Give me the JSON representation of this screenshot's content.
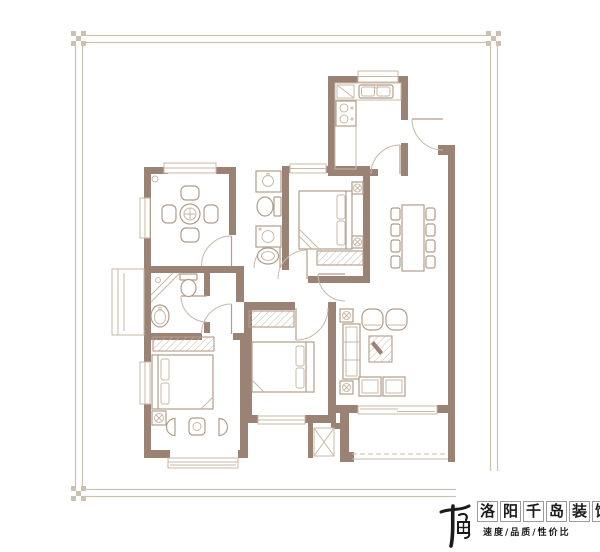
{
  "brand": {
    "logo_mark": "千岛",
    "name": "洛阳千岛装饰",
    "tagline": "速度/品质/性价比"
  },
  "colors": {
    "wall": "#9a8374",
    "furniture": "#b29c8a",
    "fine": "#c9b9a6",
    "frame": "#ccc0ae",
    "ink": "#1b1b1b",
    "background": "#ffffff"
  },
  "floorplan": {
    "type": "residential-floor-plan",
    "rooms": [
      "study",
      "kitchen",
      "bathroom-1",
      "bedroom-1",
      "dining-area",
      "living-room",
      "bathroom-2",
      "bedroom-2",
      "bedroom-3",
      "balcony",
      "entry",
      "duct-shaft"
    ],
    "fixtures": [
      "round-table",
      "chairs",
      "kitchen-sink",
      "stove",
      "toilet",
      "wash-basin",
      "washing-machine",
      "shower",
      "double-bed",
      "nightstand-lamp",
      "wardrobe",
      "dining-table-8-seats",
      "sofa",
      "coffee-table",
      "armchairs",
      "side-tables",
      "bay-window",
      "duct-shaft-x"
    ]
  }
}
